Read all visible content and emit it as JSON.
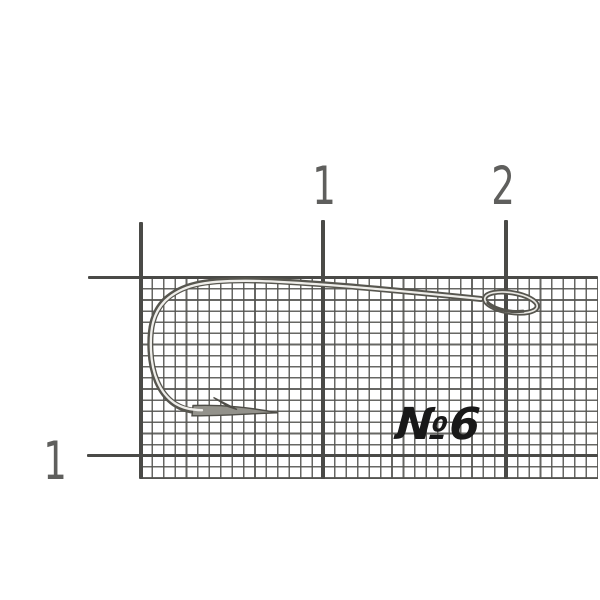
{
  "image": {
    "description": "Fishing hook photographed on measurement grid card",
    "background": "#ffffff"
  },
  "ruler": {
    "top_labels": [
      "1",
      "2"
    ],
    "left_labels": [
      "1"
    ],
    "line_color": "#4a4a47",
    "label_color": "#5f5f5d"
  },
  "grid": {
    "line_color": "#52524e",
    "cell_width_px": 11.42,
    "cell_height_px": 11.12
  },
  "hook": {
    "size_label": "№6",
    "label_color": "#191919",
    "metal_edge_color": "#57564f",
    "metal_highlight_color": "#efeeea"
  }
}
